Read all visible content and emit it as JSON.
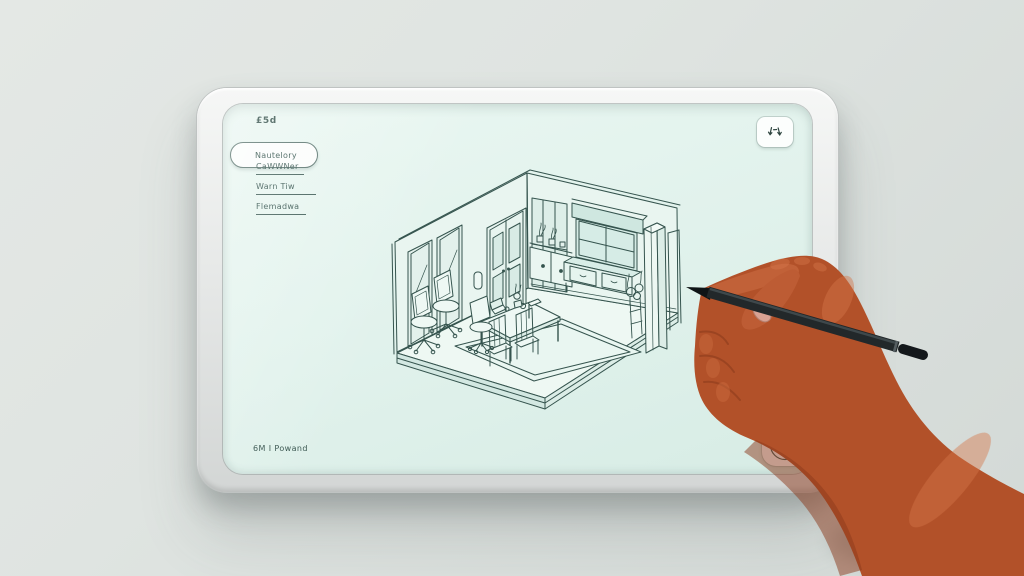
{
  "screen_ui": {
    "logo": "£5d",
    "nav": {
      "active": "Nautelory",
      "items": [
        "CaWWNer",
        "Warn Tiw",
        "Flemadwa"
      ]
    },
    "footer": "6M I Powand",
    "drawing_subject": "isometric room interior sketch"
  },
  "icons": {
    "top_right": "resize-arrows-icon",
    "bottom_right": "pen-nib-logo-icon"
  },
  "colors": {
    "wall": "#dfe4e1",
    "frame": "#e8eae9",
    "screen": "#e2f1ec",
    "ink": "#35544e",
    "skin": "#b5572e",
    "stylus": "#22282a"
  }
}
